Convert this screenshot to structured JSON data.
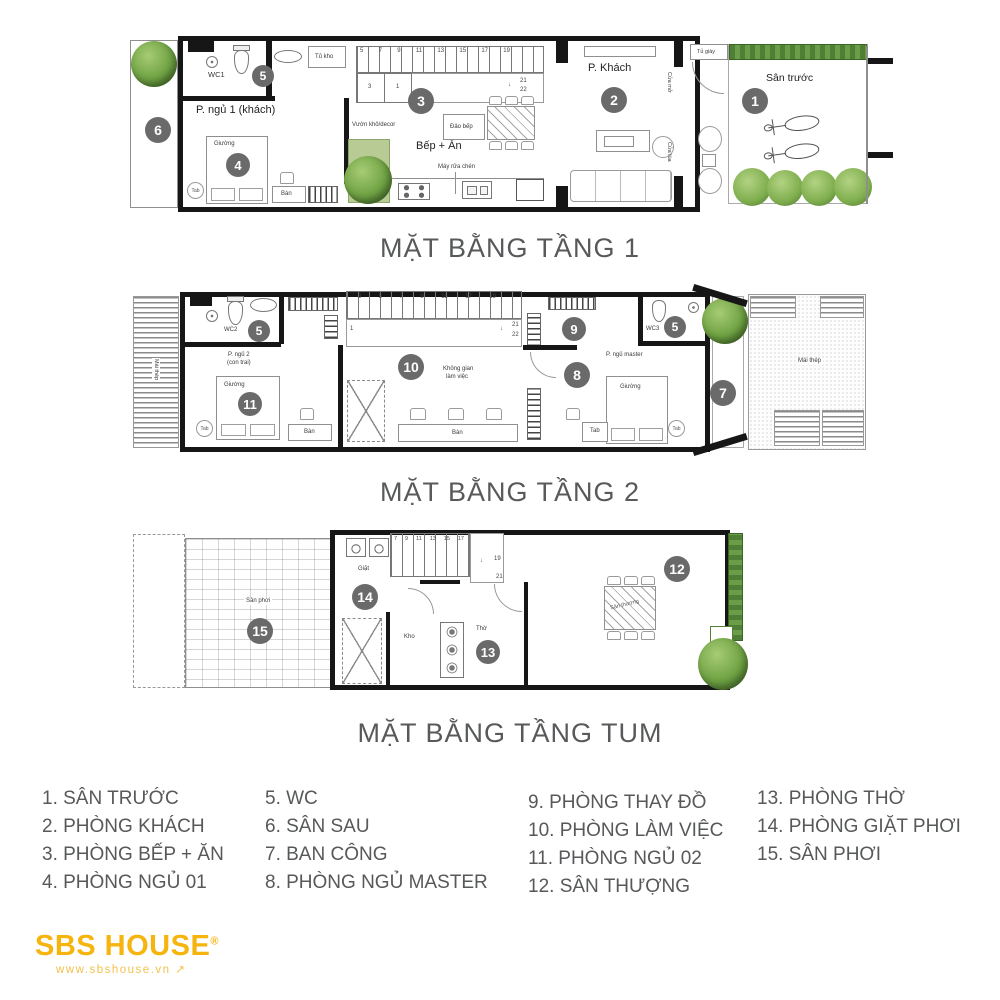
{
  "shared": {
    "tab": "Tab",
    "bed": "Giường",
    "desk": "Bàn",
    "roof": "Mái thép",
    "m5": "5"
  },
  "icons": {
    "down_arrow": "↓",
    "ne_arrow": "↗"
  },
  "floor1": {
    "title": "MẶT BẰNG TẦNG 1",
    "wc1": "WC1",
    "bedroom": "P. ngủ 1 (khách)",
    "storage": "Tủ kho",
    "dry_garden": "Vườn khô/decor",
    "kitchen": "Bếp + Ăn",
    "island": "Đảo bếp",
    "dishwasher": "Máy rửa chén",
    "living": "P. Khách",
    "shoe_cabinet": "Tủ giày",
    "door_open": "Cửa mở",
    "door_slide": "Cửa lùa",
    "front_yard": "Sân trước",
    "m1": "1",
    "m2": "2",
    "m3": "3",
    "m4": "4",
    "m6": "6",
    "stairs": [
      "5",
      "7",
      "9",
      "11",
      "13",
      "15",
      "17",
      "19"
    ],
    "s3": "3",
    "s1": "1",
    "s21": "21",
    "s22": "22"
  },
  "floor2": {
    "title": "MẶT BẰNG TẦNG 2",
    "wc2": "WC2",
    "wc3": "WC3",
    "bedroom_l1": "P. ngủ 2",
    "bedroom_l2": "(con trai)",
    "master": "P. ngủ master",
    "workspace_l1": "Không gian",
    "workspace_l2": "làm việc",
    "m7": "7",
    "m8": "8",
    "m9": "9",
    "m10": "10",
    "m11": "11",
    "stairs": [
      "3",
      "5",
      "7",
      "9",
      "15",
      "17",
      "19"
    ],
    "s1": "1",
    "s21": "21",
    "s22": "22"
  },
  "tum": {
    "title": "MẶT BẰNG TẦNG TUM",
    "drying_yard": "Sân phơi",
    "laundry": "Giặt",
    "storage": "Kho",
    "altar": "Thờ",
    "terrace_table": "Sân thượng",
    "m12": "12",
    "m13": "13",
    "m14": "14",
    "m15": "15",
    "stairs": [
      "7",
      "9",
      "11",
      "13",
      "15",
      "17"
    ],
    "s19": "19",
    "s21": "21"
  },
  "legend": {
    "col1": [
      "1. SÂN TRƯỚC",
      "2. PHÒNG KHÁCH",
      "3. PHÒNG BẾP + ĂN",
      "4. PHÒNG NGỦ 01"
    ],
    "col2": [
      "5. WC",
      "6. SÂN SAU",
      "7. BAN CÔNG",
      "8. PHÒNG NGỦ MASTER"
    ],
    "col3": [
      "9. PHÒNG THAY ĐỒ",
      "10. PHÒNG LÀM VIỆC",
      "11. PHÒNG NGỦ 02",
      "12. SÂN THƯỢNG"
    ],
    "col4": [
      "13. PHÒNG THỜ",
      "14. PHÒNG GIẶT PHƠI",
      "15. SÂN PHƠI"
    ]
  },
  "logo": {
    "name": "SBS HOUSE",
    "reg": "®",
    "site": "www.sbshouse.vn"
  },
  "colors": {
    "logo_yellow": "#F6B40E",
    "marker_gray": "#6A6A6A",
    "text_gray": "#58595B",
    "tree_green": "#6FA243"
  }
}
